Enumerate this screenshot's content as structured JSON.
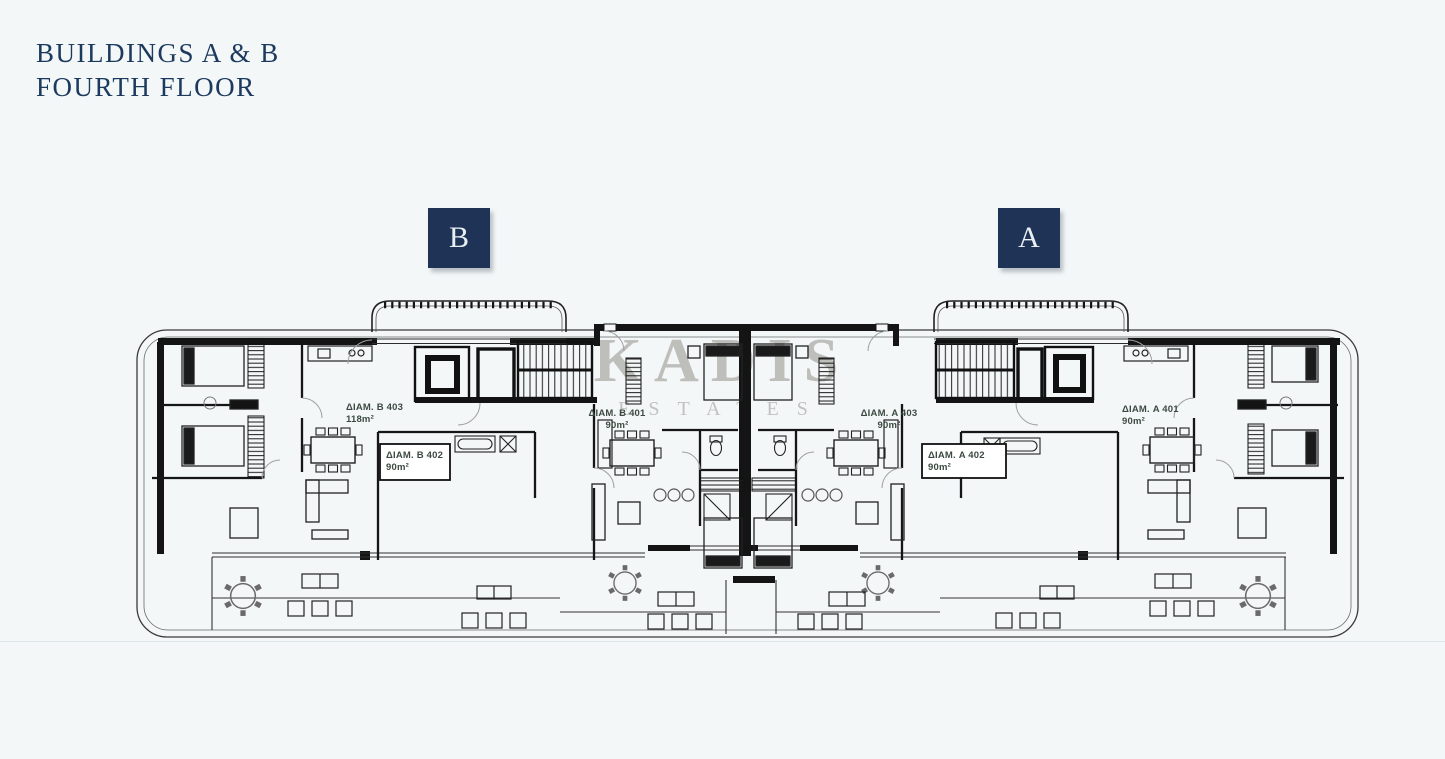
{
  "header": {
    "title_line1": "BUILDINGS A & B",
    "title_line2": "FOURTH FLOOR"
  },
  "badges": {
    "building_b": "B",
    "building_a": "A"
  },
  "watermark": {
    "line1": "KADIS",
    "line2": "ESTATES"
  },
  "apartments": [
    {
      "id": "b403",
      "name": "ΔΙΑΜ. B 403",
      "area": "118m²"
    },
    {
      "id": "b402",
      "name": "ΔΙΑΜ. B 402",
      "area": "90m²"
    },
    {
      "id": "b401",
      "name": "ΔΙΑΜ. B 401",
      "area": "90m²"
    },
    {
      "id": "a403",
      "name": "ΔΙΑΜ. A 403",
      "area": "90m²"
    },
    {
      "id": "a402",
      "name": "ΔΙΑΜ. A 402",
      "area": "90m²"
    },
    {
      "id": "a401",
      "name": "ΔΙΑΜ. A 401",
      "area": "90m²"
    }
  ],
  "colors": {
    "background": "#f3f7f8",
    "title_text": "#1c3a5e",
    "badge_background": "#1e3355",
    "badge_text": "#e9eef3",
    "plan_lines": "#1d1d1d",
    "apartment_label": "#3d4a41",
    "watermark": "#8b8680"
  }
}
